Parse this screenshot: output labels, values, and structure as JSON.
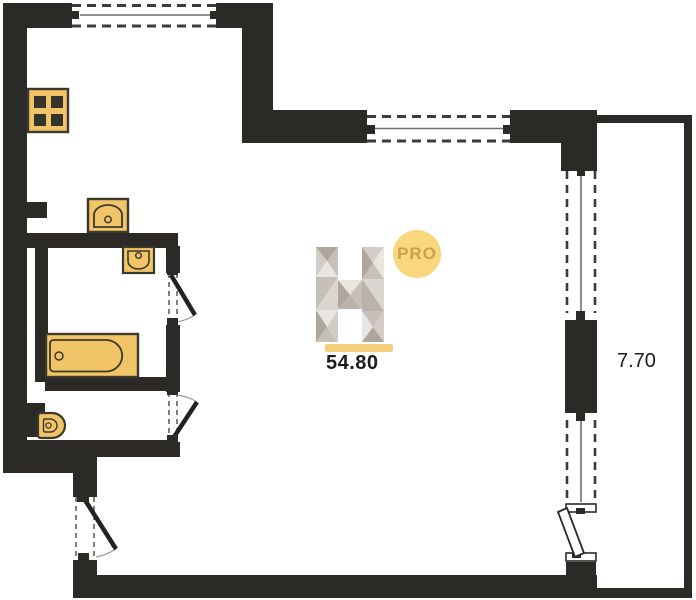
{
  "floor_plan": {
    "total_area": "54.80",
    "balcony_area": "7.70",
    "logo": {
      "letter": "H",
      "badge": "PRO"
    },
    "fixtures": [
      "stove",
      "kitchen-sink",
      "washbasin",
      "bathtub",
      "toilet"
    ],
    "colors": {
      "wall": "#2b2a27",
      "fixture_fill": "#f1c468",
      "fixture_stroke": "#3b382c",
      "accent_bar": "#f4cf7b",
      "badge_bg": "#f8d77d",
      "badge_text": "#c9a24b",
      "label_text": "#1c1c1a"
    }
  }
}
